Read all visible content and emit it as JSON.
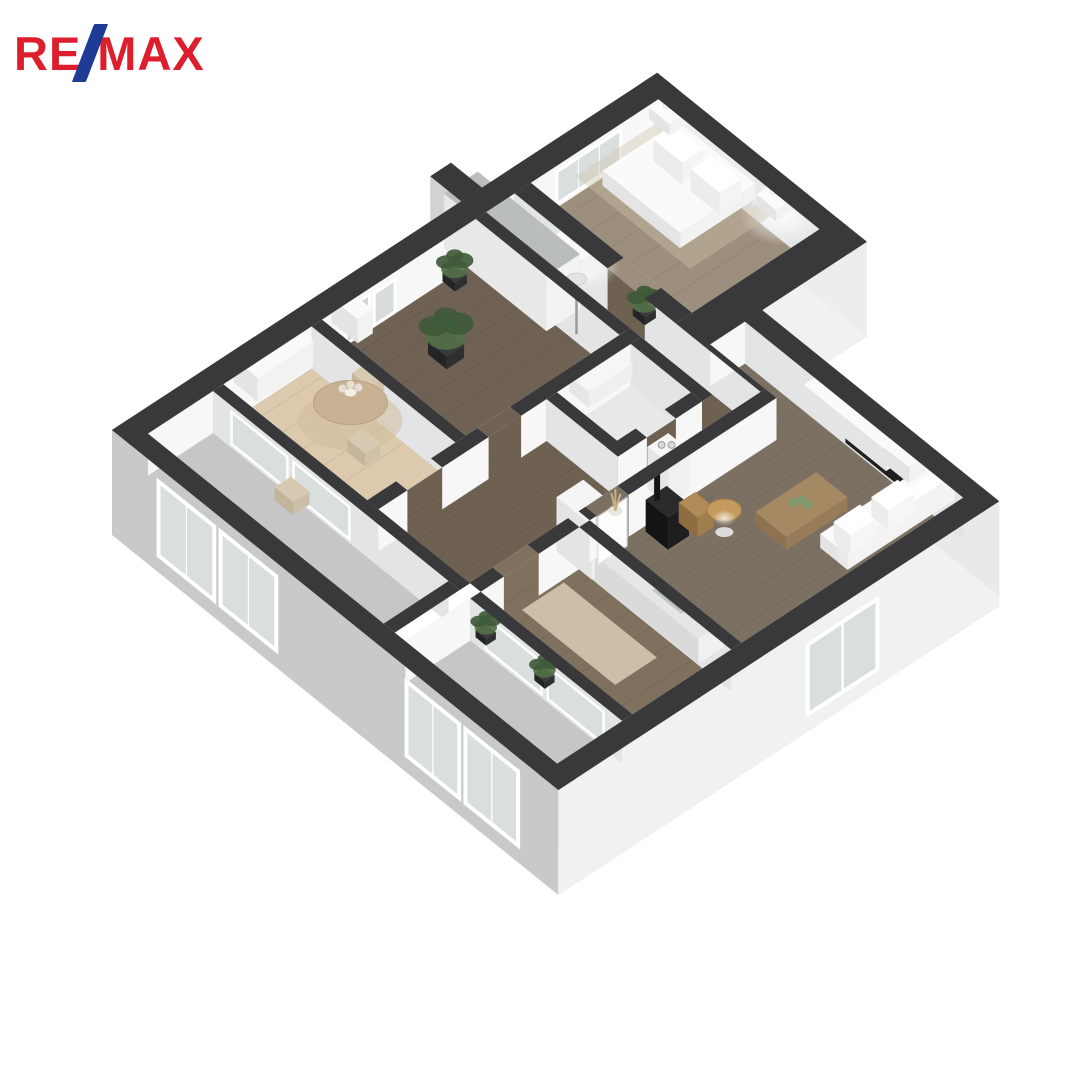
{
  "logo": {
    "part1": "RE",
    "slash": "/",
    "part2": "MAX"
  },
  "palette": {
    "logo_red": "#dd1f2d",
    "logo_blue": "#1e3c96",
    "background": "#ffffff",
    "wall_cap": "#39393b",
    "wall_face_bright": "#f7f7f7",
    "wall_face_shadow": "#e2e4e6",
    "wall_ext_sw": "#c9c9c9",
    "wall_ext_se": "#f1f1f1",
    "wall_ext_e": "#e9e9e9",
    "wall_ext_ne": "#ededed",
    "floor_hall": "#6e6152",
    "floor_wardrobe_room": "#6f6254",
    "floor_dining": "#dcc9ae",
    "floor_kitchen": "#80715e",
    "floor_living": "#7c7063",
    "floor_bedroom": "#9d8f7d",
    "floor_balcony": "#c6c6c8",
    "floor_bathroom": "#e7e9e9",
    "glass": "#d9dedf",
    "furniture_white_top": "#fafafa",
    "furniture_white_left": "#e4e4e4",
    "furniture_white_right": "#f2f2f2",
    "furniture_black": "#1d1d1f",
    "wood_table": "#a58962",
    "rug_beige": "#d9cdb6",
    "greenery": "#557049",
    "greenery_dark": "#3f5a38",
    "plant_pot": "#2f2f31",
    "rattan": "#c49a5f",
    "firewood": "#b08a57",
    "tv_screen": "#1f1f21",
    "picture_frame": "#d0d4d4"
  },
  "rooms": [
    {
      "id": "bedroom"
    },
    {
      "id": "entry-corridor"
    },
    {
      "id": "wardrobe-room"
    },
    {
      "id": "dining-nook"
    },
    {
      "id": "bathroom"
    },
    {
      "id": "balcony"
    },
    {
      "id": "hallway"
    },
    {
      "id": "kitchen"
    },
    {
      "id": "loggia"
    },
    {
      "id": "living-room"
    }
  ]
}
